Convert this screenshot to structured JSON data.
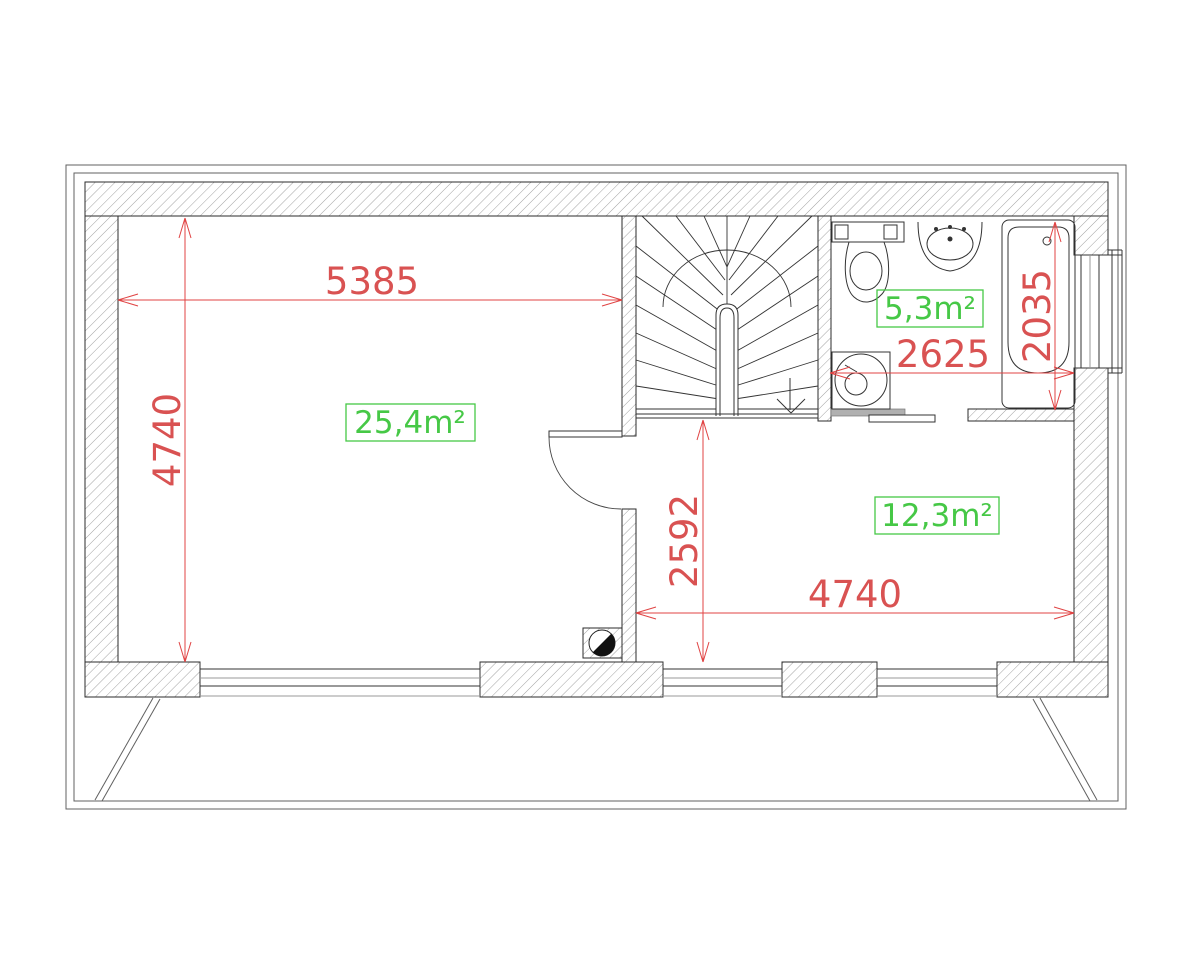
{
  "drawing": {
    "type": "architectural floor plan",
    "rooms": [
      {
        "id": "living",
        "area_label": "25,4m²"
      },
      {
        "id": "bathroom",
        "area_label": "5,3m²"
      },
      {
        "id": "bedroom",
        "area_label": "12,3m²"
      }
    ],
    "dims": {
      "d5385": {
        "value": "5385"
      },
      "d4740_left": {
        "value": "4740"
      },
      "d2035": {
        "value": "2035"
      },
      "d2625": {
        "value": "2625"
      },
      "d2592": {
        "value": "2592"
      },
      "d4740_right": {
        "value": "4740"
      }
    },
    "areas": {
      "living": {
        "value": "25,4m²"
      },
      "bath": {
        "value": "5,3m²"
      },
      "bedroom": {
        "value": "12,3m²"
      }
    },
    "colors": {
      "dimension_red": "#d95252",
      "area_green": "#46c846",
      "wall_outline": "#2b2b2b",
      "hatch_gray": "#979797",
      "background": "#ffffff"
    },
    "symbols": [
      "staircase-winder",
      "door-swing",
      "sliding-door",
      "toilet",
      "sink",
      "bathtub",
      "washing-machine",
      "flue",
      "windows",
      "roof-outline"
    ]
  }
}
